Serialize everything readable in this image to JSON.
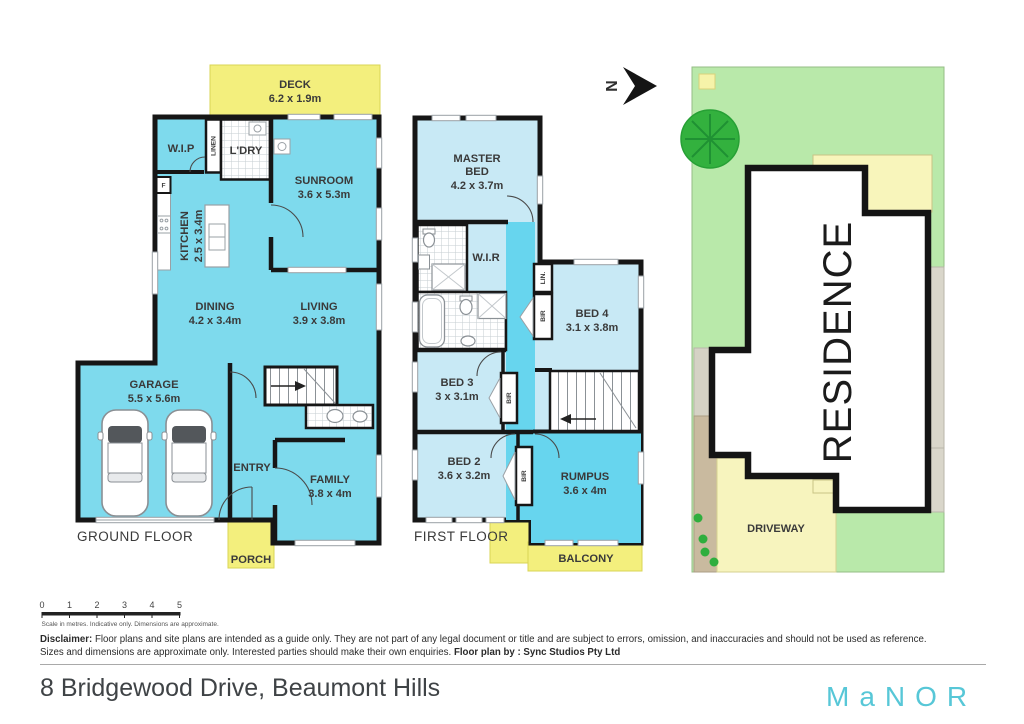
{
  "colors": {
    "room-cyan": "#7edaed",
    "room-light-blue": "#c8e9f5",
    "hall-cyan": "#67d5ee",
    "deck-yellow": "#f3ef7d",
    "site-deck-yellow": "#f8f5bb",
    "lawn-green": "#b9e9aa",
    "tree-green": "#2fae3e",
    "driveway-yellow": "#f7f4be",
    "path-tan": "#c9ba9f",
    "strip-gray": "#d9d6ca",
    "wall-black": "#161616",
    "brand-teal": "#57c7d7"
  },
  "north": {
    "label": "N"
  },
  "ground_floor": {
    "floor_label": "GROUND FLOOR",
    "deck": {
      "name": "DECK",
      "dims": "6.2 x 1.9m"
    },
    "wip": {
      "name": "W.I.P"
    },
    "linen": {
      "name": "LINEN"
    },
    "ldry": {
      "name": "L'DRY"
    },
    "sunroom": {
      "name": "SUNROOM",
      "dims": "3.6 x 5.3m"
    },
    "kitchen": {
      "name": "KITCHEN",
      "dims": "2.5 x 3.4m"
    },
    "fridge": {
      "name": "F"
    },
    "dining": {
      "name": "DINING",
      "dims": "4.2 x 3.4m"
    },
    "living": {
      "name": "LIVING",
      "dims": "3.9 x 3.8m"
    },
    "garage": {
      "name": "GARAGE",
      "dims": "5.5 x 5.6m"
    },
    "entry": {
      "name": "ENTRY"
    },
    "family": {
      "name": "FAMILY",
      "dims": "3.8 x 4m"
    },
    "porch": {
      "name": "PORCH"
    }
  },
  "first_floor": {
    "floor_label": "FIRST FLOOR",
    "master": {
      "line1": "MASTER",
      "line2": "BED",
      "dims": "4.2 x 3.7m"
    },
    "wir": {
      "name": "W.I.R"
    },
    "lin": {
      "name": "LIN."
    },
    "bir": {
      "name": "BIR"
    },
    "bed4": {
      "name": "BED 4",
      "dims": "3.1 x 3.8m"
    },
    "bed3": {
      "name": "BED 3",
      "dims": "3 x 3.1m"
    },
    "bed2": {
      "name": "BED 2",
      "dims": "3.6 x 3.2m"
    },
    "rumpus": {
      "name": "RUMPUS",
      "dims": "3.6 x 4m"
    },
    "balcony": {
      "name": "BALCONY"
    }
  },
  "site_plan": {
    "residence": "RESIDENCE",
    "driveway": "DRIVEWAY"
  },
  "scale_bar": {
    "ticks": [
      "0",
      "1",
      "2",
      "3",
      "4",
      "5"
    ],
    "caption": "Scale in metres. Indicative only. Dimensions are approximate."
  },
  "disclaimer": {
    "label": "Disclaimer:",
    "line1": "Floor plans and site plans are intended as a guide only. They are not part of any legal document or title and are subject to errors, omission, and inaccuracies and should not be used as reference.",
    "line2": "Sizes and dimensions are approximate only. Interested parties should make their own enquiries.",
    "credit": "Floor plan by : Sync Studios Pty Ltd"
  },
  "footer": {
    "address": "8 Bridgewood Drive, Beaumont Hills",
    "logo": "MaNOR"
  }
}
